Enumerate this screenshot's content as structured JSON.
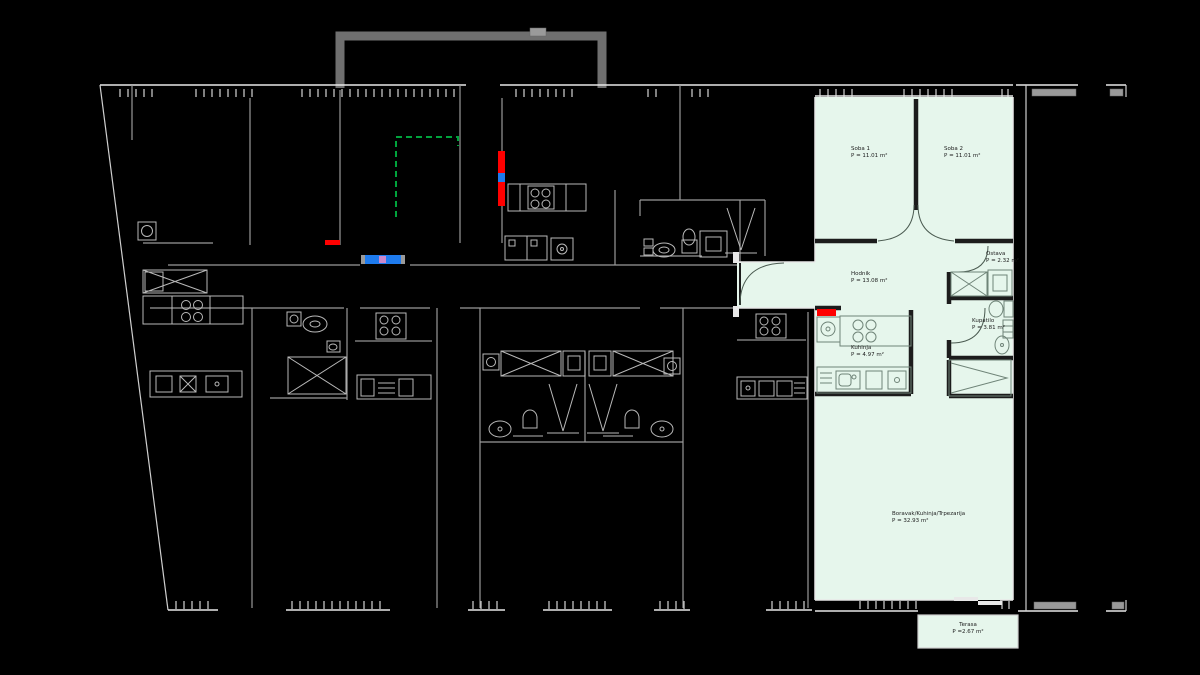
{
  "colors": {
    "background": "#000000",
    "building_line": "#e8e8e8",
    "muted_line": "#9a9a9a",
    "furniture_line": "#b9b9b9",
    "highlight_fill": "#e6f6ec",
    "highlight_wall": "#1c1c1c",
    "apartment_furniture": "#6f8478",
    "label_text": "#1c1c1c",
    "accent_red": "#ff0000",
    "accent_green": "#00a33c",
    "accent_blue": "#1e7bee",
    "canopy_gray": "#6f6f6f"
  },
  "apartment": {
    "rooms": [
      {
        "name": "Soba 1",
        "area": "P = 11.01 m²"
      },
      {
        "name": "Soba 2",
        "area": "P = 11.01 m²"
      },
      {
        "name": "Hodnik",
        "area": "P = 13.08 m²"
      },
      {
        "name": "Ostava",
        "area": "P = 2.32 m²"
      },
      {
        "name": "Kupatilo",
        "area": "P = 3.81 m²"
      },
      {
        "name": "Kuhinja",
        "area": "P = 4.97 m²"
      },
      {
        "name": "Boravak/Kuhinja/Trpezarija",
        "area": "P = 32.93 m²"
      },
      {
        "name": "Terasa",
        "area": "P =2.67 m²"
      }
    ]
  }
}
